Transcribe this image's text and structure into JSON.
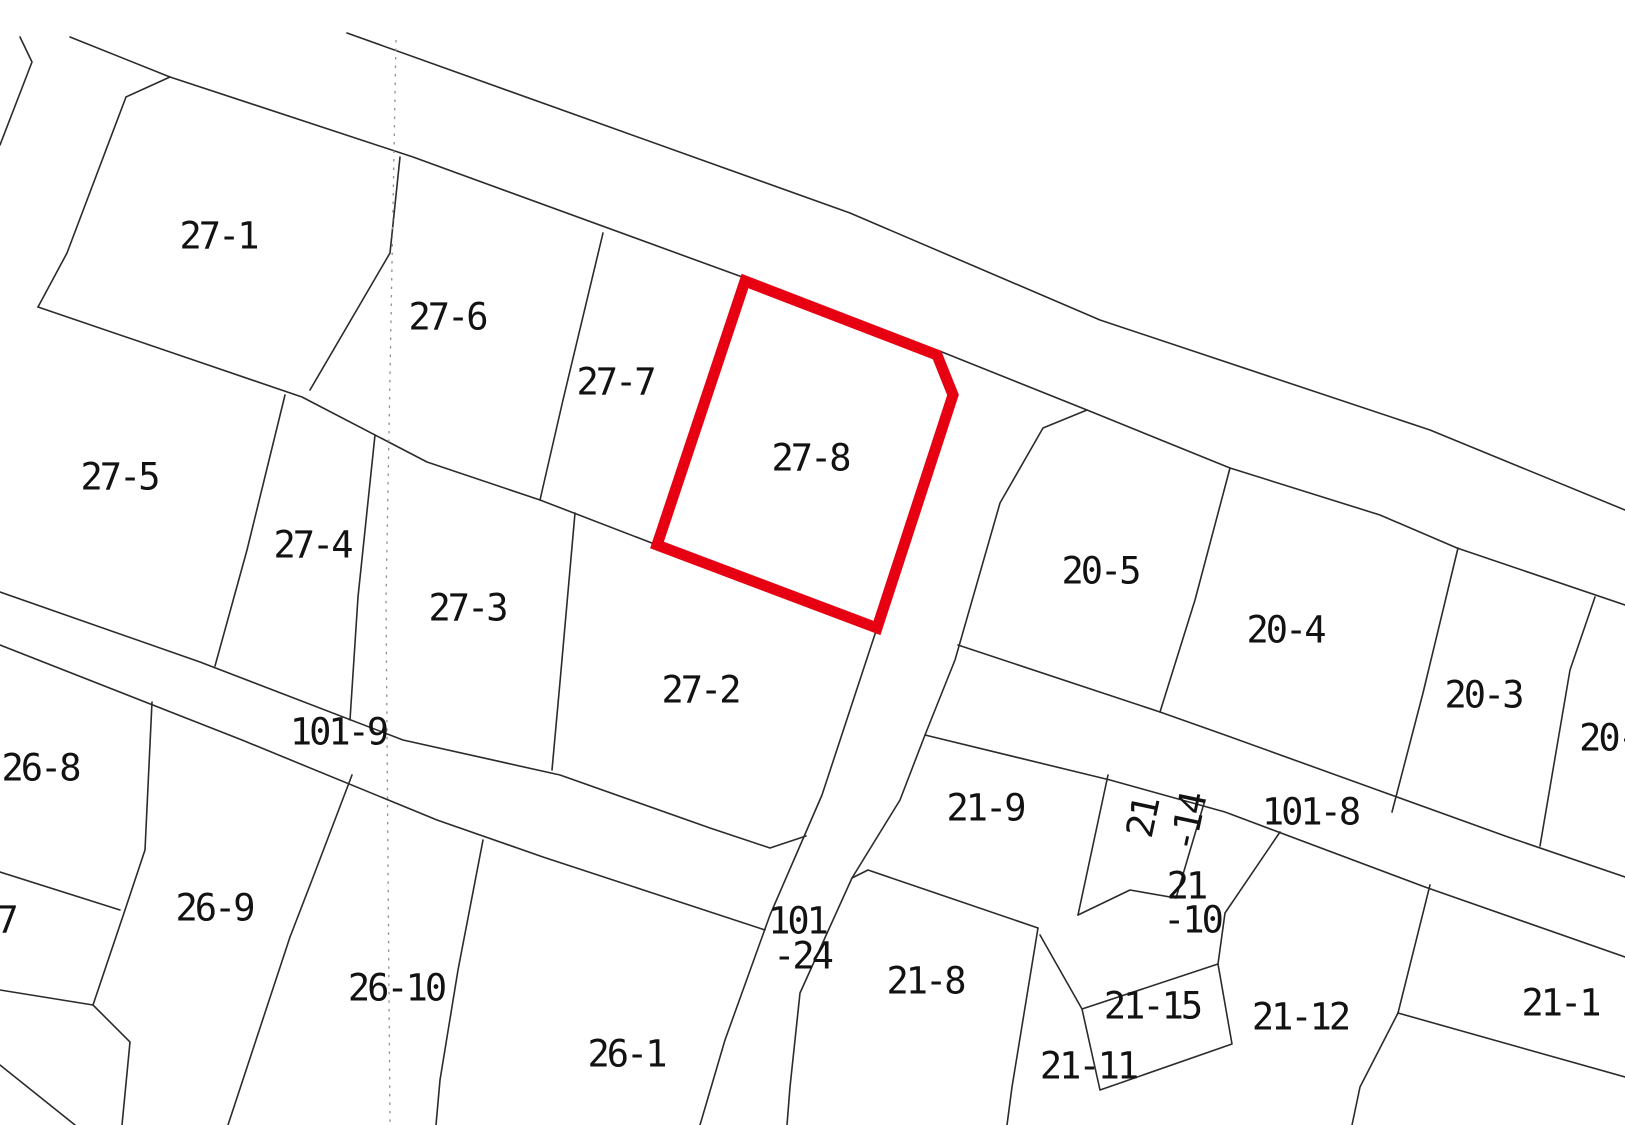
{
  "map": {
    "kind": "cadastral-parcel-map",
    "background": "#ffffff",
    "line_color": "#2b2b2b",
    "dotted_line_color": "#8f8f8f",
    "highlight_color": "#e60012",
    "highlighted_parcel": "27-8",
    "road_names": [
      "101-9",
      "101-24",
      "101-8"
    ],
    "parcel_numbers": [
      "27-1",
      "27-6",
      "27-7",
      "27-8",
      "27-5",
      "27-4",
      "27-3",
      "27-2",
      "26-8",
      "7",
      "26-9",
      "26-10",
      "26-1",
      "21-8",
      "21-9",
      "21-14",
      "21-10",
      "21-15",
      "21-11",
      "21-12",
      "21-1",
      "20-5",
      "20-4",
      "20-3",
      "20-"
    ],
    "red_polygon": [
      [
        745,
        281
      ],
      [
        937,
        355
      ],
      [
        953,
        395
      ],
      [
        877,
        628
      ],
      [
        657,
        545
      ]
    ],
    "dotted_line": [
      [
        396,
        40
      ],
      [
        386,
        600
      ],
      [
        390,
        1125
      ]
    ],
    "boundaries": [
      [
        [
          347,
          33
        ],
        [
          850,
          213
        ],
        [
          1100,
          320
        ],
        [
          1430,
          430
        ],
        [
          1625,
          510
        ]
      ],
      [
        [
          70,
          37
        ],
        [
          170,
          77
        ],
        [
          413,
          157
        ],
        [
          745,
          278
        ],
        [
          942,
          352
        ],
        [
          1087,
          410
        ],
        [
          1230,
          468
        ],
        [
          1380,
          515
        ],
        [
          1457,
          548
        ],
        [
          1625,
          605
        ]
      ],
      [
        [
          20,
          37
        ],
        [
          32,
          62
        ],
        [
          0,
          145
        ]
      ],
      [
        [
          170,
          77
        ],
        [
          126,
          97
        ],
        [
          67,
          253
        ],
        [
          38,
          307
        ]
      ],
      [
        [
          38,
          307
        ],
        [
          302,
          397
        ],
        [
          427,
          462
        ],
        [
          540,
          500
        ],
        [
          657,
          545
        ]
      ],
      [
        [
          400,
          157
        ],
        [
          390,
          253
        ],
        [
          310,
          390
        ]
      ],
      [
        [
          603,
          233
        ],
        [
          563,
          400
        ],
        [
          540,
          500
        ]
      ],
      [
        [
          285,
          395
        ],
        [
          247,
          550
        ],
        [
          215,
          666
        ]
      ],
      [
        [
          375,
          435
        ],
        [
          358,
          597
        ],
        [
          350,
          720
        ]
      ],
      [
        [
          575,
          513
        ],
        [
          560,
          682
        ],
        [
          552,
          770
        ]
      ],
      [
        [
          0,
          592
        ],
        [
          200,
          662
        ],
        [
          403,
          740
        ],
        [
          560,
          775
        ],
        [
          710,
          828
        ],
        [
          770,
          848
        ],
        [
          806,
          836
        ]
      ],
      [
        [
          0,
          645
        ],
        [
          242,
          740
        ],
        [
          437,
          820
        ],
        [
          543,
          857
        ],
        [
          765,
          930
        ]
      ],
      [
        [
          877,
          628
        ],
        [
          822,
          795
        ],
        [
          770,
          915
        ],
        [
          725,
          1040
        ],
        [
          700,
          1125
        ]
      ],
      [
        [
          1087,
          410
        ],
        [
          1043,
          428
        ],
        [
          1000,
          503
        ],
        [
          955,
          660
        ],
        [
          925,
          735
        ],
        [
          900,
          800
        ],
        [
          852,
          878
        ],
        [
          800,
          993
        ],
        [
          790,
          1087
        ],
        [
          787,
          1125
        ]
      ],
      [
        [
          958,
          645
        ],
        [
          1160,
          712
        ],
        [
          1225,
          735
        ],
        [
          1372,
          788
        ],
        [
          1508,
          837
        ],
        [
          1625,
          877
        ]
      ],
      [
        [
          925,
          735
        ],
        [
          1110,
          780
        ],
        [
          1225,
          812
        ],
        [
          1425,
          887
        ],
        [
          1625,
          957
        ]
      ],
      [
        [
          1230,
          468
        ],
        [
          1195,
          600
        ],
        [
          1160,
          712
        ]
      ],
      [
        [
          1458,
          548
        ],
        [
          1423,
          693
        ],
        [
          1392,
          812
        ]
      ],
      [
        [
          1595,
          597
        ],
        [
          1570,
          670
        ],
        [
          1540,
          846
        ]
      ],
      [
        [
          852,
          878
        ],
        [
          868,
          870
        ],
        [
          1038,
          928
        ]
      ],
      [
        [
          1038,
          928
        ],
        [
          1012,
          1087
        ],
        [
          1007,
          1125
        ]
      ],
      [
        [
          1040,
          935
        ],
        [
          1082,
          1009
        ]
      ],
      [
        [
          1082,
          1009
        ],
        [
          1218,
          964
        ],
        [
          1232,
          1044
        ],
        [
          1100,
          1090
        ],
        [
          1082,
          1009
        ]
      ],
      [
        [
          1108,
          775
        ],
        [
          1078,
          915
        ]
      ],
      [
        [
          1205,
          800
        ],
        [
          1176,
          898
        ]
      ],
      [
        [
          1078,
          915
        ],
        [
          1130,
          890
        ],
        [
          1176,
          898
        ]
      ],
      [
        [
          1280,
          832
        ],
        [
          1225,
          913
        ],
        [
          1218,
          964
        ]
      ],
      [
        [
          1430,
          885
        ],
        [
          1398,
          1013
        ]
      ],
      [
        [
          1398,
          1013
        ],
        [
          1625,
          1077
        ]
      ],
      [
        [
          1398,
          1013
        ],
        [
          1360,
          1087
        ],
        [
          1352,
          1125
        ]
      ],
      [
        [
          0,
          872
        ],
        [
          120,
          910
        ]
      ],
      [
        [
          152,
          702
        ],
        [
          145,
          850
        ],
        [
          125,
          910
        ],
        [
          93,
          1005
        ]
      ],
      [
        [
          93,
          1005
        ],
        [
          130,
          1042
        ],
        [
          122,
          1125
        ]
      ],
      [
        [
          0,
          990
        ],
        [
          93,
          1005
        ]
      ],
      [
        [
          0,
          1065
        ],
        [
          75,
          1125
        ]
      ],
      [
        [
          352,
          775
        ],
        [
          312,
          880
        ],
        [
          290,
          937
        ],
        [
          256,
          1040
        ],
        [
          228,
          1125
        ]
      ],
      [
        [
          483,
          840
        ],
        [
          458,
          970
        ],
        [
          440,
          1080
        ],
        [
          436,
          1125
        ]
      ]
    ],
    "labels": [
      {
        "name": "parcel-label-27-1",
        "text": "27-1",
        "x": 218,
        "y": 236
      },
      {
        "name": "parcel-label-27-6",
        "text": "27-6",
        "x": 447,
        "y": 317
      },
      {
        "name": "parcel-label-27-7",
        "text": "27-7",
        "x": 615,
        "y": 382
      },
      {
        "name": "parcel-label-27-8",
        "text": "27-8",
        "x": 810,
        "y": 458
      },
      {
        "name": "parcel-label-27-5",
        "text": "27-5",
        "x": 119,
        "y": 477
      },
      {
        "name": "parcel-label-27-4",
        "text": "27-4",
        "x": 312,
        "y": 545
      },
      {
        "name": "parcel-label-27-3",
        "text": "27-3",
        "x": 467,
        "y": 608
      },
      {
        "name": "parcel-label-27-2",
        "text": "27-2",
        "x": 700,
        "y": 690
      },
      {
        "name": "road-label-101-9",
        "text": "101-9",
        "x": 338,
        "y": 732
      },
      {
        "name": "parcel-label-26-8",
        "text": "26-8",
        "x": 40,
        "y": 768
      },
      {
        "name": "parcel-label-7",
        "text": "7",
        "x": 6,
        "y": 920
      },
      {
        "name": "parcel-label-26-9",
        "text": "26-9",
        "x": 214,
        "y": 908
      },
      {
        "name": "parcel-label-26-10",
        "text": "26-10",
        "x": 396,
        "y": 988
      },
      {
        "name": "parcel-label-26-1",
        "text": "26-1",
        "x": 626,
        "y": 1054
      },
      {
        "name": "road-label-101-24-line1",
        "text": "101",
        "x": 797,
        "y": 921
      },
      {
        "name": "road-label-101-24-line2",
        "text": "-24",
        "x": 802,
        "y": 956
      },
      {
        "name": "parcel-label-21-8",
        "text": "21-8",
        "x": 925,
        "y": 981
      },
      {
        "name": "parcel-label-21-9",
        "text": "21-9",
        "x": 985,
        "y": 808
      },
      {
        "name": "parcel-label-21-14-line1",
        "text": "21",
        "x": 1143,
        "y": 818,
        "rot": -78
      },
      {
        "name": "parcel-label-21-14-line2",
        "text": "-14",
        "x": 1188,
        "y": 823,
        "rot": -78
      },
      {
        "name": "parcel-label-21-10-line1",
        "text": "21",
        "x": 1186,
        "y": 886
      },
      {
        "name": "parcel-label-21-10-line2",
        "text": "-10",
        "x": 1192,
        "y": 920
      },
      {
        "name": "road-label-101-8",
        "text": "101-8",
        "x": 1310,
        "y": 812
      },
      {
        "name": "parcel-label-21-15",
        "text": "21-15",
        "x": 1152,
        "y": 1006
      },
      {
        "name": "parcel-label-21-11",
        "text": "21-11",
        "x": 1088,
        "y": 1066
      },
      {
        "name": "parcel-label-21-12",
        "text": "21-12",
        "x": 1300,
        "y": 1017
      },
      {
        "name": "parcel-label-21-1",
        "text": "21-1",
        "x": 1560,
        "y": 1003
      },
      {
        "name": "parcel-label-20-5",
        "text": "20-5",
        "x": 1100,
        "y": 571
      },
      {
        "name": "parcel-label-20-4",
        "text": "20-4",
        "x": 1285,
        "y": 630
      },
      {
        "name": "parcel-label-20-3",
        "text": "20-3",
        "x": 1483,
        "y": 695
      },
      {
        "name": "parcel-label-20-edge",
        "text": "20-",
        "x": 1608,
        "y": 738
      }
    ]
  }
}
